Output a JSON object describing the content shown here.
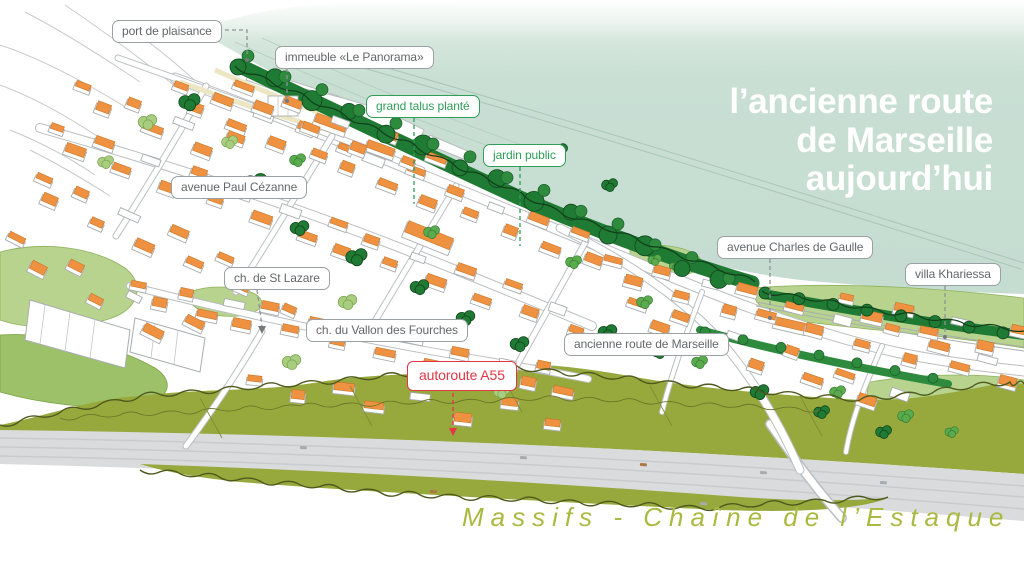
{
  "title": {
    "lines": [
      "l’ancienne route",
      "de Marseille",
      "aujourd’hui"
    ]
  },
  "caption": {
    "text": "Massifs - Chaîne de l’Estaque"
  },
  "annotations": [
    {
      "id": "port-de-plaisance",
      "text": "port de plaisance",
      "style": "gray"
    },
    {
      "id": "immeuble-le-panorama",
      "text": "immeuble «Le Panorama»",
      "style": "gray"
    },
    {
      "id": "grand-talus-plante",
      "text": "grand talus planté",
      "style": "green"
    },
    {
      "id": "jardin-public",
      "text": "jardin public",
      "style": "green"
    },
    {
      "id": "avenue-paul-cezanne",
      "text": "avenue Paul Cézanne",
      "style": "gray"
    },
    {
      "id": "ch-de-st-lazare",
      "text": "ch. de St Lazare",
      "style": "gray"
    },
    {
      "id": "ch-du-vallon-des-fourches",
      "text": "ch. du Vallon des Fourches",
      "style": "gray"
    },
    {
      "id": "avenue-charles-de-gaulle",
      "text": "avenue Charles de Gaulle",
      "style": "gray"
    },
    {
      "id": "villa-khariessa",
      "text": "villa Khariessa",
      "style": "gray"
    },
    {
      "id": "ancienne-route-de-marseille",
      "text": "ancienne route de Marseille",
      "style": "gray"
    },
    {
      "id": "autoroute-a55",
      "text": "autoroute A55",
      "style": "red"
    }
  ],
  "colors": {
    "sea": "#c7ddd2",
    "vegetation_dark": "#1f7a33",
    "vegetation_light": "#b7d38e",
    "hills_olive": "#97a93d",
    "roof_orange": "#ee9140",
    "label_green": "#2f9e58",
    "label_red": "#e23744",
    "caption_green": "#a9ba41"
  }
}
